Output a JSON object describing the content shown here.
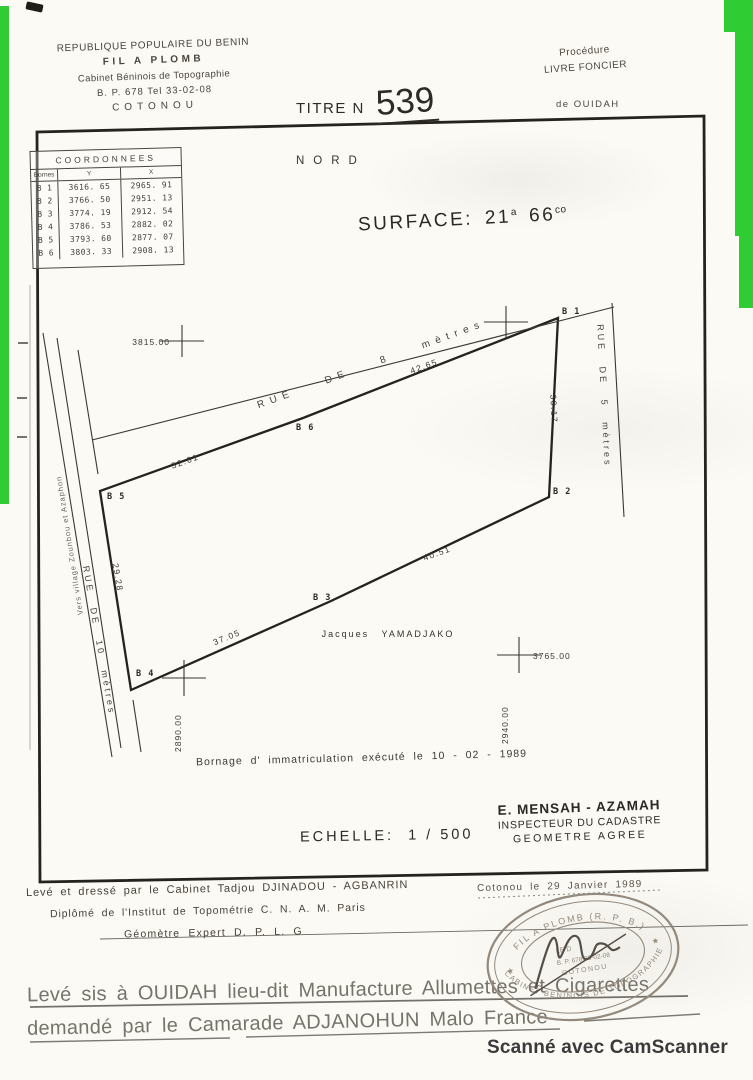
{
  "header": {
    "country": "REPUBLIQUE POPULAIRE DU BENIN",
    "firm": "FIL A PLOMB",
    "cabinet": "Cabinet Béninois de Topographie",
    "address": "B. P. 678   Tel   33-02-08",
    "city": "COTONOU",
    "title_label": "TITRE N",
    "title_number": "539",
    "procedure_label": "Procédure",
    "procedure_value": "LIVRE FONCIER",
    "of_place": "de   OUIDAH"
  },
  "coords_table": {
    "title": "COORDONNEES",
    "columns": {
      "borne": "Bornes",
      "y": "Y",
      "x": "X"
    },
    "rows": [
      {
        "borne": "B 1",
        "y": "3616. 65",
        "x": "2965. 91"
      },
      {
        "borne": "B 2",
        "y": "3766. 50",
        "x": "2951. 13"
      },
      {
        "borne": "B 3",
        "y": "3774. 19",
        "x": "2912. 54"
      },
      {
        "borne": "B 4",
        "y": "3786. 53",
        "x": "2882. 02"
      },
      {
        "borne": "B 5",
        "y": "3793. 60",
        "x": "2877. 07"
      },
      {
        "borne": "B 6",
        "y": "3803. 33",
        "x": "2908. 13"
      }
    ]
  },
  "plan": {
    "north": "NORD",
    "surface_label": "SURFACE:",
    "surface_v1": "21",
    "surface_s1": "a",
    "surface_v2": "66",
    "surface_s2": "co",
    "streets": {
      "top": "RUE DE 8 mètres",
      "right": "RUE DE 5 mètres",
      "left": "RUE DE 10 mètres"
    },
    "direction_note": "Vers village Zounbou et Azaphon",
    "owner": "Jacques  YAMADJAKO",
    "bornes": {
      "b1": "B 1",
      "b2": "B 2",
      "b3": "B 3",
      "b4": "B 4",
      "b5": "B 5",
      "b6": "B 6"
    },
    "measures": {
      "b6_b1": "42.65",
      "b1_b2": "30.17",
      "b3_b2": "40.51",
      "b4_b3": "37.05",
      "b4_b5": "29.28",
      "b5_b6": "32.61"
    },
    "grid_marks": {
      "west": "3815.00",
      "south_west": "2890.00",
      "south_east_y": "3765.00",
      "south_east_x": "2940.00"
    },
    "bornage_note": "Bornage  d' immatriculation  exécuté  le  10 - 02 - 1989",
    "echelle_label": "ECHELLE:",
    "echelle_value": "1 / 500",
    "inspector": {
      "name": "E. MENSAH - AZAMAH",
      "title1": "INSPECTEUR DU CADASTRE",
      "title2": "GEOMETRE AGREE"
    }
  },
  "footer": {
    "surveyor_line1": "Levé et dressé  par  le  Cabinet  Tadjou  DJINADOU - AGBANRIN",
    "surveyor_line2": "Diplômé  de  l'Institut  de  Topométrie  C. N. A. M.  Paris",
    "surveyor_line3": "Géomètre  Expert  D. P. L. G",
    "place_date": "Cotonou  le  29  Janvier  1989",
    "stamp": {
      "arc_top": "FIL A PLOMB (R. P. B.)",
      "arc_bottom": "CABINET BENINOIS DE TOPOGRAPHIE",
      "line1": "LE D",
      "line2": "B. P. 678   33-02-08",
      "line3": "COTONOU"
    },
    "request_line1": "Levé sis à OUIDAH lieu-dit  Manufacture  Allumettes  et  Cigarettes",
    "request_line2": "demandé  par  le  Camarade   ADJANOHUN  Malo  France"
  },
  "scan": {
    "camscanner": "Scanné avec CamScanner"
  }
}
